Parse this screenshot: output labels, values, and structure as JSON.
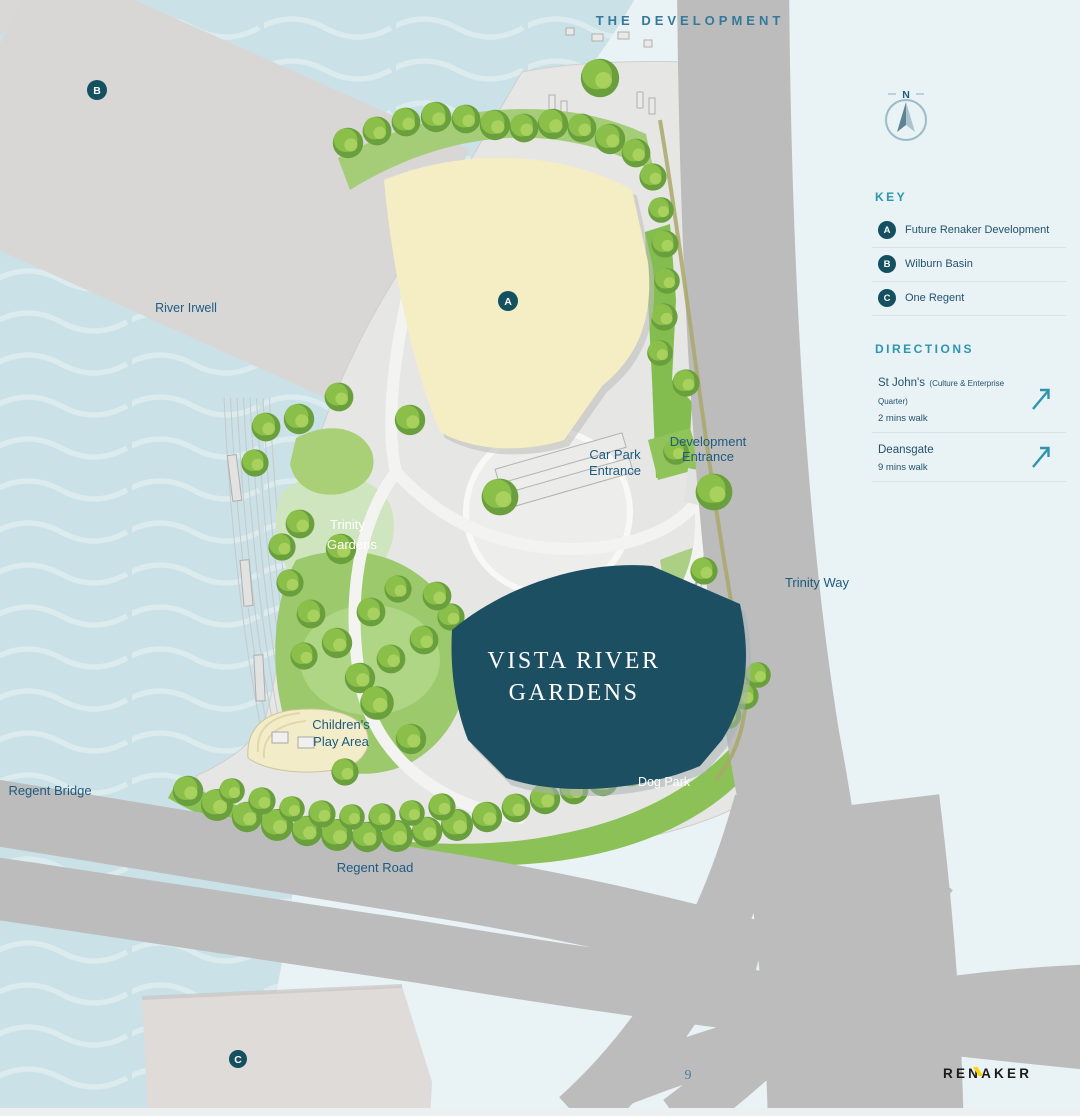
{
  "title": "THE DEVELOPMENT",
  "page_number": "9",
  "brand": {
    "logo": "RENAKER",
    "accent_color": "#ffd200"
  },
  "compass": {
    "north_label": "N"
  },
  "key": {
    "heading": "KEY",
    "items": [
      {
        "marker": "A",
        "label": "Future Renaker Development"
      },
      {
        "marker": "B",
        "label": "Wilburn Basin"
      },
      {
        "marker": "C",
        "label": "One Regent"
      }
    ]
  },
  "directions": {
    "heading": "DIRECTIONS",
    "items": [
      {
        "name": "St John's",
        "qualifier": "(Culture & Enterprise Quarter)",
        "walk_time": "2 mins walk"
      },
      {
        "name": "Deansgate",
        "qualifier": "",
        "walk_time": "9 mins walk"
      }
    ]
  },
  "map": {
    "labels": {
      "river": "River Irwell",
      "trinity_gardens_line1": "Trinity",
      "trinity_gardens_line2": "Gardens",
      "car_park_line1": "Car Park",
      "car_park_line2": "Entrance",
      "development_line1": "Development",
      "development_line2": "Entrance",
      "trinity_way": "Trinity Way",
      "building_line1": "VISTA RIVER",
      "building_line2": "GARDENS",
      "play_area_line1": "Children's",
      "play_area_line2": "Play Area",
      "dog_park": "Dog Park",
      "regent_bridge": "Regent Bridge",
      "regent_road": "Regent Road"
    },
    "markers": {
      "a": "A",
      "b": "B",
      "c": "C"
    },
    "colors": {
      "accent_teal": "#2d96ad",
      "label_navy": "#1d5b80",
      "building_teal": "#1d4f63",
      "future_development_cream": "#f5edc4",
      "marker_badge": "#14505f",
      "river": "#c9e1e7",
      "road": "#bcbcbc",
      "greenery": "#8fc353"
    }
  }
}
